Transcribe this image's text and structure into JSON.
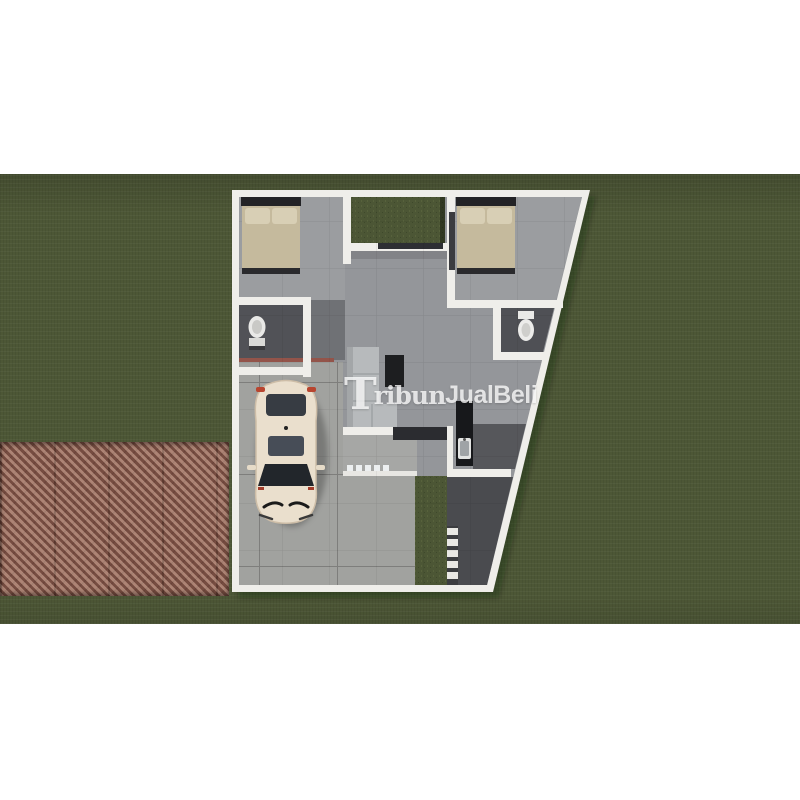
{
  "watermark": {
    "full_text": "TribunJualBeli",
    "initial": "T",
    "serif_part": "ribun",
    "sans_part": "JualBeli"
  },
  "palette": {
    "canvas": "#ffffff",
    "grass": "#4d5736",
    "road_paver": "#8d6053",
    "house_wall": "#efeeea",
    "interior_floor": "#94969a",
    "bedroom_floor": "#9b9da0",
    "carport_tile": "#a1a29f",
    "bathroom_floor": "#515257",
    "bed_linen": "#c5ba9d",
    "pillow": "#d8cfb5",
    "sofa": "#b7babc",
    "dark_furniture": "#1d1e20",
    "car_body": "#eadfcd",
    "glass_dark": "#272b31",
    "side_path": "#4a4b4f",
    "accent_brick_red": "#93544a",
    "watermark_white": "#ffffff"
  },
  "entities": [
    "grass-yard",
    "paver-road",
    "house-floor-plan",
    "bedroom-bed-left",
    "bedroom-bed-right",
    "courtyard-garden",
    "toilet-left",
    "toilet-right",
    "sofa",
    "coffee-table",
    "kitchen-counter-sink",
    "carport",
    "car",
    "terrace-sandals",
    "garden-steps",
    "side-path"
  ]
}
